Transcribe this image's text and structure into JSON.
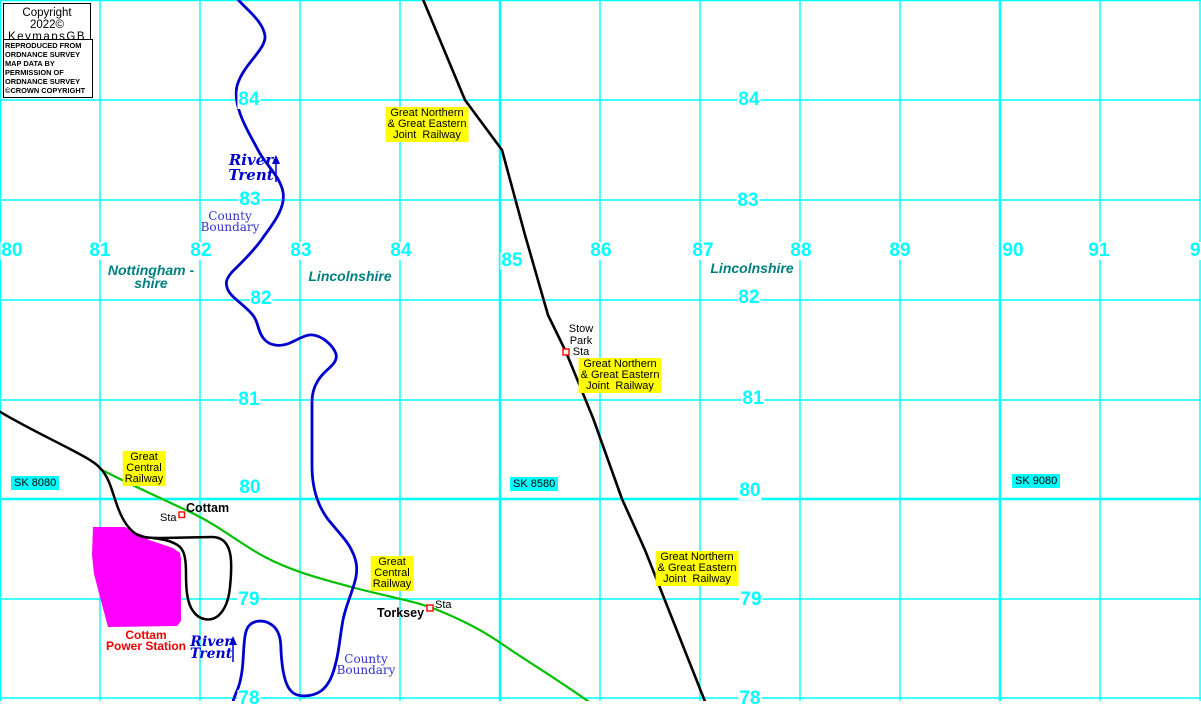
{
  "copyright_box": {
    "line1": "Copyright 2022©",
    "line2": "KeymapsGB"
  },
  "attribution_box": {
    "lines": [
      "REPRODUCED FROM",
      "ORDNANCE SURVEY",
      "MAP DATA BY",
      "PERMISSION OF",
      "ORDNANCE SURVEY",
      "©CROWN COPYRIGHT"
    ]
  },
  "colors": {
    "grid": "#00FFFF",
    "river": "#0000CC",
    "boundary": "#3333CC",
    "county": "#008080",
    "yellow": "#FFFF00",
    "green": "#00C000",
    "magenta": "#FF00FF",
    "rail": "#000000",
    "stationred": "#FF0000",
    "powerred": "#EE0000"
  },
  "grid": {
    "vertical_lines": [
      0,
      100,
      200,
      300,
      400,
      500,
      600,
      700,
      800,
      900,
      1000,
      1100,
      1200
    ],
    "horizontal_lines": [
      0,
      100,
      200,
      300,
      400,
      499,
      599,
      698
    ],
    "thick_vertical": [
      0,
      500,
      1000
    ],
    "thick_horizontal": [
      0,
      499
    ],
    "easting_labels": [
      {
        "label": "80",
        "x": 12,
        "y": 251
      },
      {
        "label": "81",
        "x": 100,
        "y": 251
      },
      {
        "label": "82",
        "x": 201,
        "y": 251
      },
      {
        "label": "83",
        "x": 301,
        "y": 251
      },
      {
        "label": "84",
        "x": 401,
        "y": 251
      },
      {
        "label": "85",
        "x": 512,
        "y": 261
      },
      {
        "label": "86",
        "x": 601,
        "y": 251
      },
      {
        "label": "87",
        "x": 703,
        "y": 251
      },
      {
        "label": "88",
        "x": 801,
        "y": 251
      },
      {
        "label": "89",
        "x": 900,
        "y": 251
      },
      {
        "label": "90",
        "x": 1013,
        "y": 251
      },
      {
        "label": "91",
        "x": 1099,
        "y": 251
      },
      {
        "label": "9",
        "x": 1189,
        "y": 251,
        "anchor": "left"
      }
    ],
    "northing_labels": [
      {
        "label": "84",
        "x": 249,
        "y": 100
      },
      {
        "label": "84",
        "x": 749,
        "y": 100
      },
      {
        "label": "83",
        "x": 250,
        "y": 200
      },
      {
        "label": "83",
        "x": 748,
        "y": 201
      },
      {
        "label": "82",
        "x": 261,
        "y": 299
      },
      {
        "label": "82",
        "x": 749,
        "y": 298
      },
      {
        "label": "81",
        "x": 249,
        "y": 400
      },
      {
        "label": "81",
        "x": 753,
        "y": 399
      },
      {
        "label": "80",
        "x": 250,
        "y": 488
      },
      {
        "label": "80",
        "x": 750,
        "y": 491
      },
      {
        "label": "79",
        "x": 249,
        "y": 600
      },
      {
        "label": "79",
        "x": 751,
        "y": 600
      },
      {
        "label": "78",
        "x": 249,
        "y": 699
      },
      {
        "label": "78",
        "x": 750,
        "y": 699
      }
    ],
    "square_labels": [
      {
        "name": "sk-8080-label",
        "cls": "lbl-sk",
        "x": 11,
        "top": 476,
        "lines": [
          "SK 8080"
        ]
      },
      {
        "name": "sk-8580-label",
        "cls": "lbl-sk",
        "x": 510,
        "top": 477,
        "lines": [
          "SK 8580"
        ]
      },
      {
        "name": "sk-9080-label",
        "cls": "lbl-sk",
        "x": 1012,
        "top": 474,
        "lines": [
          "SK 9080"
        ]
      }
    ]
  },
  "map_labels": [
    {
      "name": "gn-ge-joint-railway-label-north",
      "cls": "lbl-yellow",
      "cx": 427,
      "top": 107,
      "lines": [
        "Great Northern",
        "& Great Eastern",
        "Joint  Railway"
      ]
    },
    {
      "name": "gn-ge-joint-railway-label-mid",
      "cls": "lbl-yellow",
      "cx": 620,
      "top": 358,
      "lines": [
        "Great Northern",
        "& Great Eastern",
        "Joint  Railway"
      ]
    },
    {
      "name": "gn-ge-joint-railway-label-south",
      "cls": "lbl-yellow",
      "cx": 697,
      "top": 551,
      "lines": [
        "Great Northern",
        "& Great Eastern",
        "Joint  Railway"
      ]
    },
    {
      "name": "great-central-railway-label-north",
      "cls": "lbl-yellow",
      "cx": 144,
      "top": 451,
      "lines": [
        "Great",
        "Central",
        "Railway"
      ]
    },
    {
      "name": "great-central-railway-label-south",
      "cls": "lbl-yellow",
      "cx": 392,
      "top": 556,
      "lines": [
        "Great",
        "Central",
        "Railway"
      ]
    },
    {
      "name": "county-nottinghamshire-label",
      "cls": "lbl-county",
      "cx": 151,
      "top": 264,
      "lines": [
        "Nottingham -",
        "shire"
      ]
    },
    {
      "name": "county-lincolnshire-label-west",
      "cls": "lbl-county",
      "cx": 350,
      "top": 270,
      "lines": [
        "Lincolnshire"
      ]
    },
    {
      "name": "county-lincolnshire-label-east",
      "cls": "lbl-county",
      "cx": 752,
      "top": 262,
      "lines": [
        "Lincolnshire"
      ]
    },
    {
      "name": "river-trent-label-north",
      "cls": "lbl-river",
      "cx": 251,
      "top": 153,
      "lines": [
        "River",
        "Trent"
      ]
    },
    {
      "name": "river-trent-label-south",
      "cls": "lbl-river lbl-river-s",
      "cx": 211,
      "top": 636,
      "lines": [
        "River",
        "Trent"
      ]
    },
    {
      "name": "county-boundary-label-north",
      "cls": "lbl-boundary",
      "cx": 230,
      "top": 211,
      "lines": [
        "County",
        "Boundary"
      ]
    },
    {
      "name": "county-boundary-label-south",
      "cls": "lbl-boundary",
      "cx": 366,
      "top": 654,
      "lines": [
        "County",
        "Boundary"
      ]
    },
    {
      "name": "stow-park-station-label",
      "cls": "lbl-sta",
      "cx": 581,
      "top": 324,
      "lines": [
        "Stow",
        "Park",
        "Sta"
      ]
    },
    {
      "name": "cottam-station-name",
      "cls": "lbl-station",
      "x": 186,
      "top": 502,
      "lines": [
        "Cottam"
      ]
    },
    {
      "name": "cottam-station-sta",
      "cls": "lbl-sta",
      "x": 160,
      "top": 513,
      "lines": [
        "Sta"
      ]
    },
    {
      "name": "torksey-station-name",
      "cls": "lbl-station",
      "x": 377,
      "top": 607,
      "lines": [
        "Torksey"
      ]
    },
    {
      "name": "torksey-station-sta",
      "cls": "lbl-sta",
      "x": 435,
      "top": 600,
      "lines": [
        "Sta"
      ]
    },
    {
      "name": "cottam-power-station-label",
      "cls": "lbl-power",
      "cx": 146,
      "top": 630,
      "lines": [
        "Cottam",
        "Power Station"
      ]
    }
  ]
}
